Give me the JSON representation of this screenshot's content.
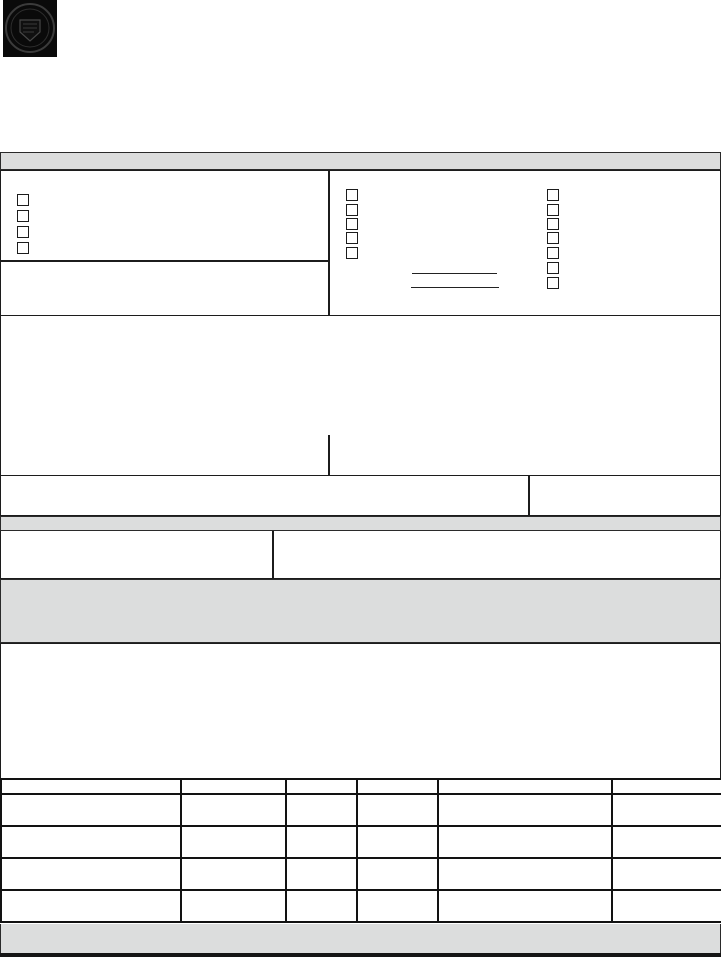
{
  "page": {
    "width": 721,
    "height": 957
  },
  "colors": {
    "background": "#ffffff",
    "line": "#1c1c1c",
    "table_line": "#121212",
    "band_fill": "#dcdddd",
    "seal_black": "#0a0a0a",
    "bottom_bar": "#151515"
  },
  "seal": {
    "icon": "circular-seal-icon"
  },
  "bands": {
    "top_label": "",
    "mid_label": "",
    "lower_label": "",
    "bottom_label": ""
  },
  "top_section": {
    "left_cell": {
      "checkboxes": [
        {
          "checked": false
        },
        {
          "checked": false
        },
        {
          "checked": false
        },
        {
          "checked": false
        }
      ],
      "lower_cell_text": ""
    },
    "right_cell": {
      "checkbox_column_1": [
        {
          "checked": false
        },
        {
          "checked": false
        },
        {
          "checked": false
        },
        {
          "checked": false
        },
        {
          "checked": false
        }
      ],
      "checkbox_column_2": [
        {
          "checked": false
        },
        {
          "checked": false
        },
        {
          "checked": false
        },
        {
          "checked": false
        },
        {
          "checked": false
        },
        {
          "checked": false
        },
        {
          "checked": false
        }
      ],
      "write_in_lines": [
        "",
        ""
      ]
    }
  },
  "main_entry_area": {
    "left_text": "",
    "right_text": ""
  },
  "split_row": {
    "left_text": "",
    "right_text": ""
  },
  "two_column_row": {
    "left_text": "",
    "right_text": ""
  },
  "notes_area": {
    "text": ""
  },
  "table": {
    "columns": [
      "",
      "",
      "",
      "",
      "",
      ""
    ],
    "rows": [
      [
        "",
        "",
        "",
        "",
        "",
        ""
      ],
      [
        "",
        "",
        "",
        "",
        "",
        ""
      ],
      [
        "",
        "",
        "",
        "",
        "",
        ""
      ],
      [
        "",
        "",
        "",
        "",
        "",
        ""
      ]
    ]
  }
}
